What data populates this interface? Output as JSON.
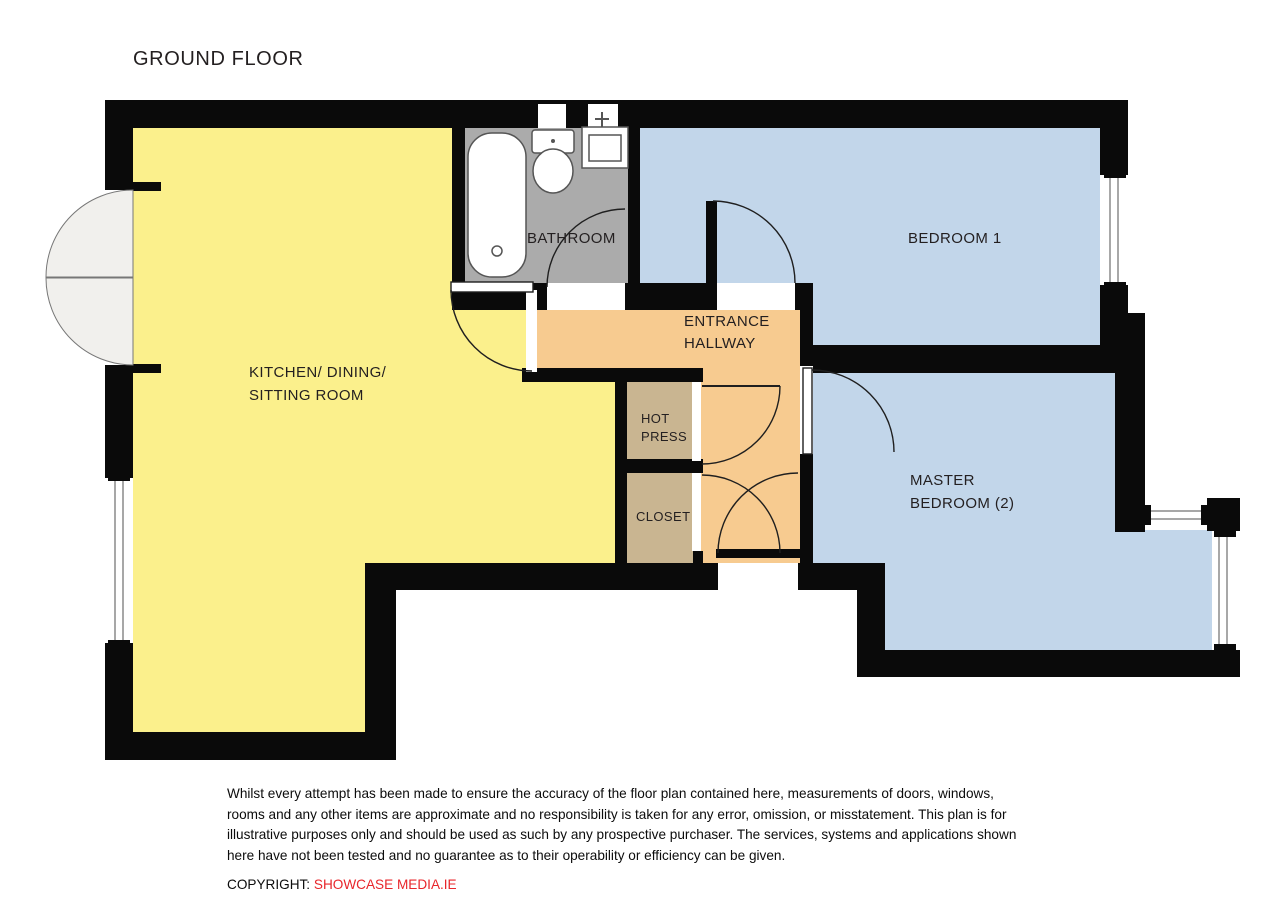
{
  "header": {
    "title": "GROUND FLOOR"
  },
  "palette": {
    "wall": "#0a0a0a",
    "label": "#231F20",
    "window_line": "#8a8a8a",
    "door_arc": "#1f1f1f",
    "fixture_stroke": "#555555",
    "copyright_red": "#E8262B"
  },
  "rooms": {
    "kitchen": {
      "line1": "KITCHEN/ DINING/",
      "line2": "SITTING ROOM",
      "color": "#FBF08C"
    },
    "bathroom": {
      "label": "BATHROOM",
      "color": "#ABABAB"
    },
    "bedroom1": {
      "label": "BEDROOM 1",
      "color": "#C2D6EA"
    },
    "hallway": {
      "line1": "ENTRANCE",
      "line2": "HALLWAY",
      "color": "#F7CB90"
    },
    "hot_press": {
      "line1": "HOT",
      "line2": "PRESS",
      "color": "#C9B591"
    },
    "closet": {
      "label": "CLOSET",
      "color": "#C9B591"
    },
    "master_bedroom": {
      "line1": "MASTER",
      "line2": "BEDROOM (2)",
      "color": "#C2D6EA"
    }
  },
  "footer": {
    "disclaimer_lines": [
      "Whilst every attempt has been made to ensure the accuracy of the floor plan contained here, measurements of doors, windows,",
      "rooms and any other items are approximate and no responsibility is taken for any error, omission, or misstatement.  This plan is for",
      "illustrative purposes only and should be used as such by any prospective purchaser.  The services, systems and applications shown",
      "here have not been tested and no guarantee as to their operability or efficiency can be given."
    ],
    "copyright_label": "COPYRIGHT:",
    "copyright_value": "SHOWCASE MEDIA.IE"
  }
}
